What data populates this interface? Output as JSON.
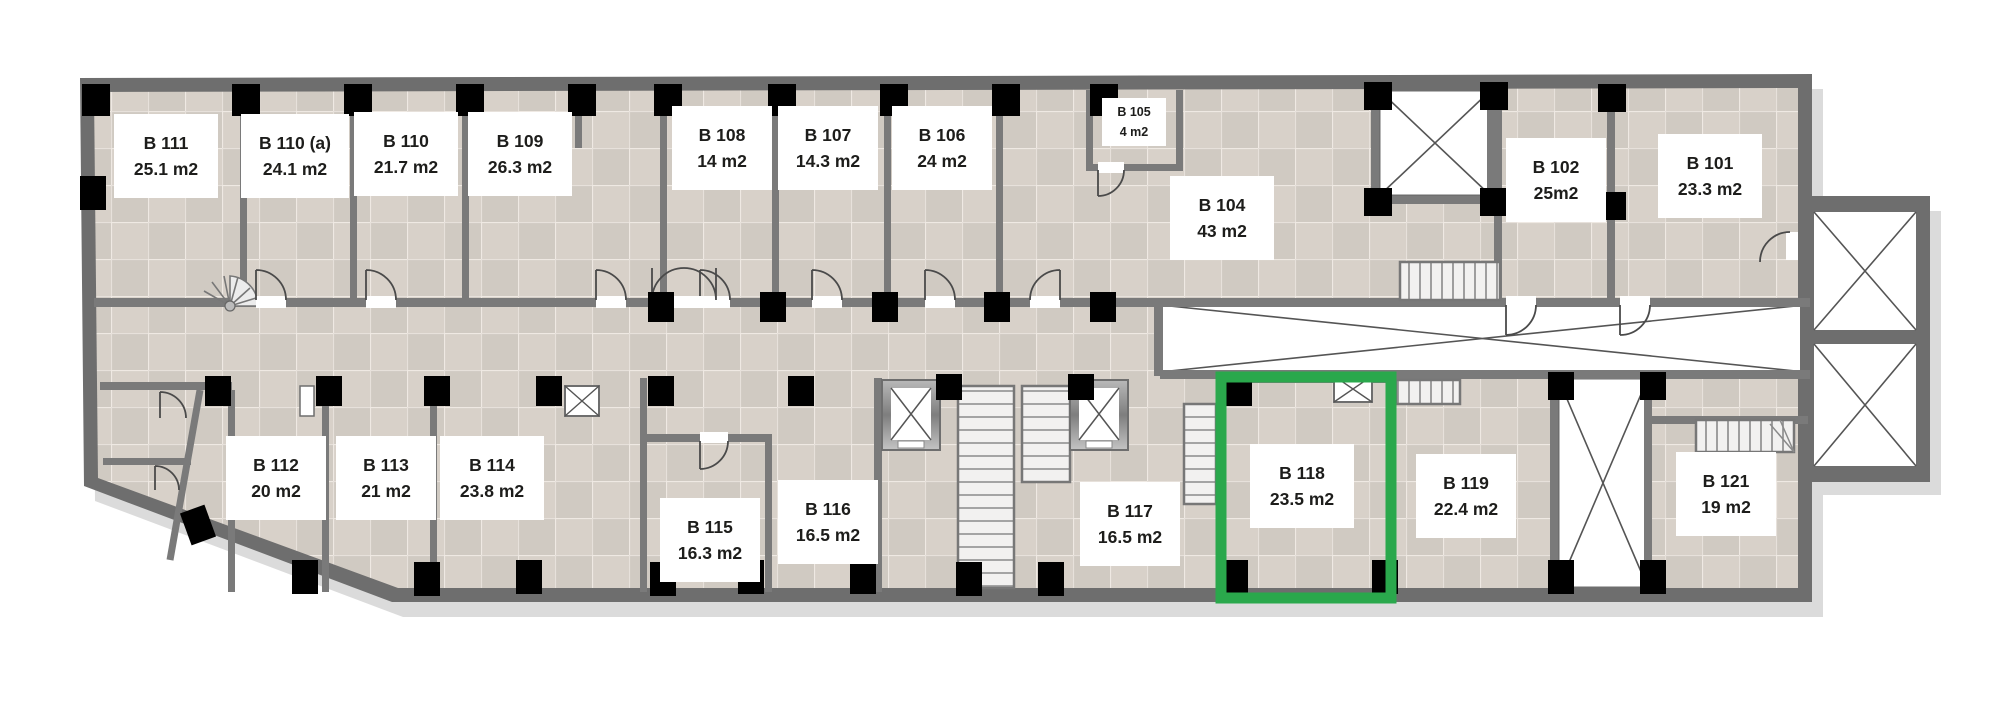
{
  "plan": {
    "type": "floor-plan",
    "highlight_color": "#2aa84c",
    "floor_color": "#d8d1c9",
    "floor_line_color": "#efe9e3",
    "wall_color": "#6e6e6e",
    "inner_wall_color": "#7a7a7a",
    "column_color": "#000000",
    "label_bg": "#ffffff",
    "label_text_color": "#1d1d1b",
    "shaft_line_color": "#555555",
    "highlighted_room": "B 118"
  },
  "rooms": [
    {
      "id": "b111",
      "name": "B 111",
      "area": "25.1 m2",
      "cx": 166,
      "cy": 156,
      "w": 104,
      "h": 84,
      "small": false,
      "highlighted": false
    },
    {
      "id": "b110a",
      "name": "B 110 (a)",
      "area": "24.1 m2",
      "cx": 295,
      "cy": 156,
      "w": 108,
      "h": 84,
      "small": false,
      "highlighted": false
    },
    {
      "id": "b110",
      "name": "B 110",
      "area": "21.7 m2",
      "cx": 406,
      "cy": 154,
      "w": 104,
      "h": 84,
      "small": false,
      "highlighted": false
    },
    {
      "id": "b109",
      "name": "B 109",
      "area": "26.3 m2",
      "cx": 520,
      "cy": 154,
      "w": 104,
      "h": 84,
      "small": false,
      "highlighted": false
    },
    {
      "id": "b108",
      "name": "B 108",
      "area": "14 m2",
      "cx": 722,
      "cy": 148,
      "w": 100,
      "h": 84,
      "small": false,
      "highlighted": false
    },
    {
      "id": "b107",
      "name": "B 107",
      "area": "14.3 m2",
      "cx": 828,
      "cy": 148,
      "w": 100,
      "h": 84,
      "small": false,
      "highlighted": false
    },
    {
      "id": "b106",
      "name": "B 106",
      "area": "24 m2",
      "cx": 942,
      "cy": 148,
      "w": 100,
      "h": 84,
      "small": false,
      "highlighted": false
    },
    {
      "id": "b105",
      "name": "B 105",
      "area": "4 m2",
      "cx": 1134,
      "cy": 122,
      "w": 64,
      "h": 48,
      "small": true,
      "highlighted": false
    },
    {
      "id": "b104",
      "name": "B 104",
      "area": "43 m2",
      "cx": 1222,
      "cy": 218,
      "w": 104,
      "h": 84,
      "small": false,
      "highlighted": false
    },
    {
      "id": "b102",
      "name": "B 102",
      "area": "25m2",
      "cx": 1556,
      "cy": 180,
      "w": 100,
      "h": 84,
      "small": false,
      "highlighted": false
    },
    {
      "id": "b101",
      "name": "B 101",
      "area": "23.3 m2",
      "cx": 1710,
      "cy": 176,
      "w": 104,
      "h": 84,
      "small": false,
      "highlighted": false
    },
    {
      "id": "b112",
      "name": "B 112",
      "area": "20 m2",
      "cx": 276,
      "cy": 478,
      "w": 100,
      "h": 84,
      "small": false,
      "highlighted": false
    },
    {
      "id": "b113",
      "name": "B 113",
      "area": "21 m2",
      "cx": 386,
      "cy": 478,
      "w": 100,
      "h": 84,
      "small": false,
      "highlighted": false
    },
    {
      "id": "b114",
      "name": "B 114",
      "area": "23.8 m2",
      "cx": 492,
      "cy": 478,
      "w": 104,
      "h": 84,
      "small": false,
      "highlighted": false
    },
    {
      "id": "b115",
      "name": "B 115",
      "area": "16.3 m2",
      "cx": 710,
      "cy": 540,
      "w": 100,
      "h": 84,
      "small": false,
      "highlighted": false
    },
    {
      "id": "b116",
      "name": "B 116",
      "area": "16.5 m2",
      "cx": 828,
      "cy": 522,
      "w": 100,
      "h": 84,
      "small": false,
      "highlighted": false
    },
    {
      "id": "b117",
      "name": "B 117",
      "area": "16.5 m2",
      "cx": 1130,
      "cy": 524,
      "w": 100,
      "h": 84,
      "small": false,
      "highlighted": false
    },
    {
      "id": "b118",
      "name": "B 118",
      "area": "23.5 m2",
      "cx": 1302,
      "cy": 486,
      "w": 104,
      "h": 84,
      "small": false,
      "highlighted": true
    },
    {
      "id": "b119",
      "name": "B 119",
      "area": "22.4 m2",
      "cx": 1466,
      "cy": 496,
      "w": 100,
      "h": 84,
      "small": false,
      "highlighted": false
    },
    {
      "id": "b121",
      "name": "B 121",
      "area": "19 m2",
      "cx": 1726,
      "cy": 494,
      "w": 100,
      "h": 84,
      "small": false,
      "highlighted": false
    }
  ],
  "features": {
    "icons": [
      "elevator-shaft-icon",
      "ventilation-shaft-icon",
      "stairs-icon",
      "spiral-stairs-icon",
      "door-swing-icon",
      "light-well-icon",
      "column-icon"
    ]
  }
}
